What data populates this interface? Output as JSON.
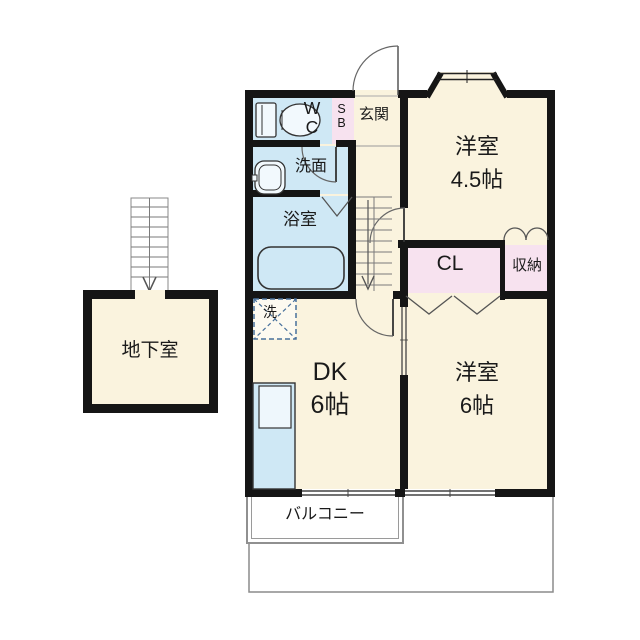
{
  "colors": {
    "cream": "#faf3de",
    "room_blue": "#cfe8f5",
    "room_pink": "#f7e2ef",
    "wall": "#151515",
    "outline_gray": "#8c8c8c"
  },
  "rooms": {
    "wc": "WC",
    "shoe_box": "SB",
    "entrance": "玄関",
    "washroom": "洗面",
    "bathroom": "浴室",
    "western_room_45": {
      "name": "洋室",
      "size": "4.5帖"
    },
    "closet": "CL",
    "storage": "収納",
    "dining_kitchen": {
      "name": "DK",
      "size": "6帖"
    },
    "western_room_6": {
      "name": "洋室",
      "size": "6帖"
    },
    "laundry": "洗",
    "balcony": "バルコニー",
    "basement": "地下室"
  }
}
